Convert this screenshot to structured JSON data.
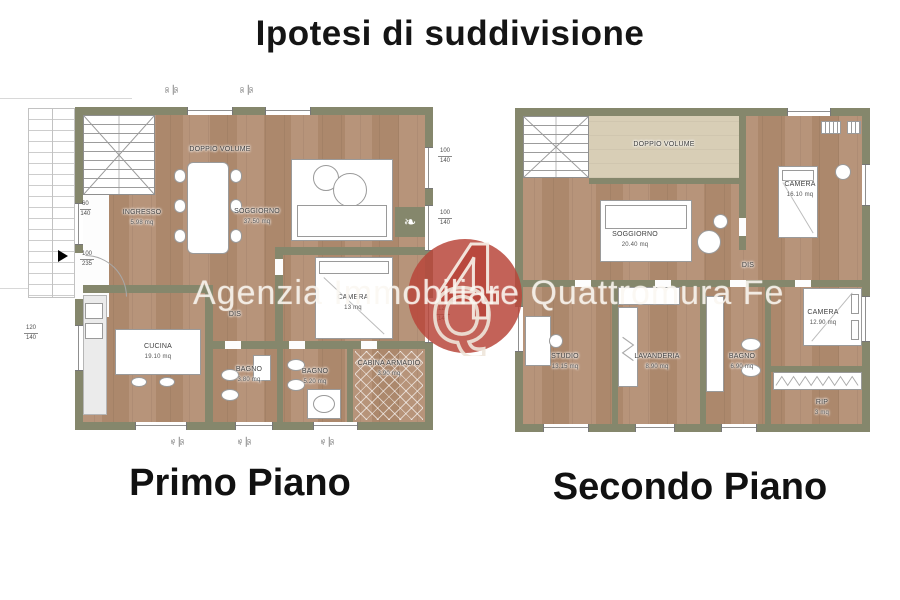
{
  "title": "Ipotesi di suddivisione",
  "watermark": {
    "text": "Agenzia Immobiliare Quattromura Fe",
    "logo_top": "4",
    "logo_letter": "Q"
  },
  "icons": {
    "plant": "❧"
  },
  "edge_dims": {
    "top": {
      "a": "90",
      "b": "50"
    },
    "bottom": {
      "a": "45",
      "b": "50"
    }
  },
  "colors": {
    "wall": "#85876c",
    "floor": "#b28f74",
    "doppio_volume_floor": "#d8ceb6",
    "logo_red": "#b9463b"
  },
  "primo": {
    "caption": "Primo Piano",
    "rooms": {
      "doppio_volume": {
        "name": "DOPPIO VOLUME",
        "area": ""
      },
      "ingresso": {
        "name": "INGRESSO",
        "area": "5.98 mq"
      },
      "soggiorno": {
        "name": "SOGGIORNO",
        "area": "37.50 mq"
      },
      "camera": {
        "name": "CAMERA",
        "area": "13 mq"
      },
      "cucina": {
        "name": "CUCINA",
        "area": "19.10 mq"
      },
      "dis": {
        "name": "DIS",
        "area": ""
      },
      "bagno1": {
        "name": "BAGNO",
        "area": "3.80 mq"
      },
      "bagno2": {
        "name": "BAGNO",
        "area": "5.20 mq"
      },
      "cabina": {
        "name": "CABINA ARMADIO",
        "area": "3.90 mq"
      }
    },
    "dims": {
      "win_ingresso": {
        "a": "60",
        "b": "140"
      },
      "door_entry": {
        "a": "100",
        "b": "235"
      },
      "win_right_1": {
        "a": "100",
        "b": "140"
      },
      "win_right_2": {
        "a": "100",
        "b": "140"
      },
      "win_camera": {
        "a": "120",
        "b": "140"
      },
      "win_cucina": {
        "a": "120",
        "b": "140"
      }
    }
  },
  "secondo": {
    "caption": "Secondo Piano",
    "rooms": {
      "doppio_volume": {
        "name": "DOPPIO VOLUME",
        "area": ""
      },
      "soggiorno": {
        "name": "SOGGIORNO",
        "area": "20.40 mq"
      },
      "camera1": {
        "name": "CAMERA",
        "area": "16.10 mq"
      },
      "dis": {
        "name": "DIS",
        "area": ""
      },
      "studio": {
        "name": "STUDIO",
        "area": "13.15 mq"
      },
      "lavanderia": {
        "name": "LAVANDERIA",
        "area": "8.90 mq"
      },
      "bagno": {
        "name": "BAGNO",
        "area": "6.90 mq"
      },
      "camera2": {
        "name": "CAMERA",
        "area": "12.90 mq"
      },
      "rip": {
        "name": "RIP",
        "area": "3 mq"
      }
    }
  }
}
